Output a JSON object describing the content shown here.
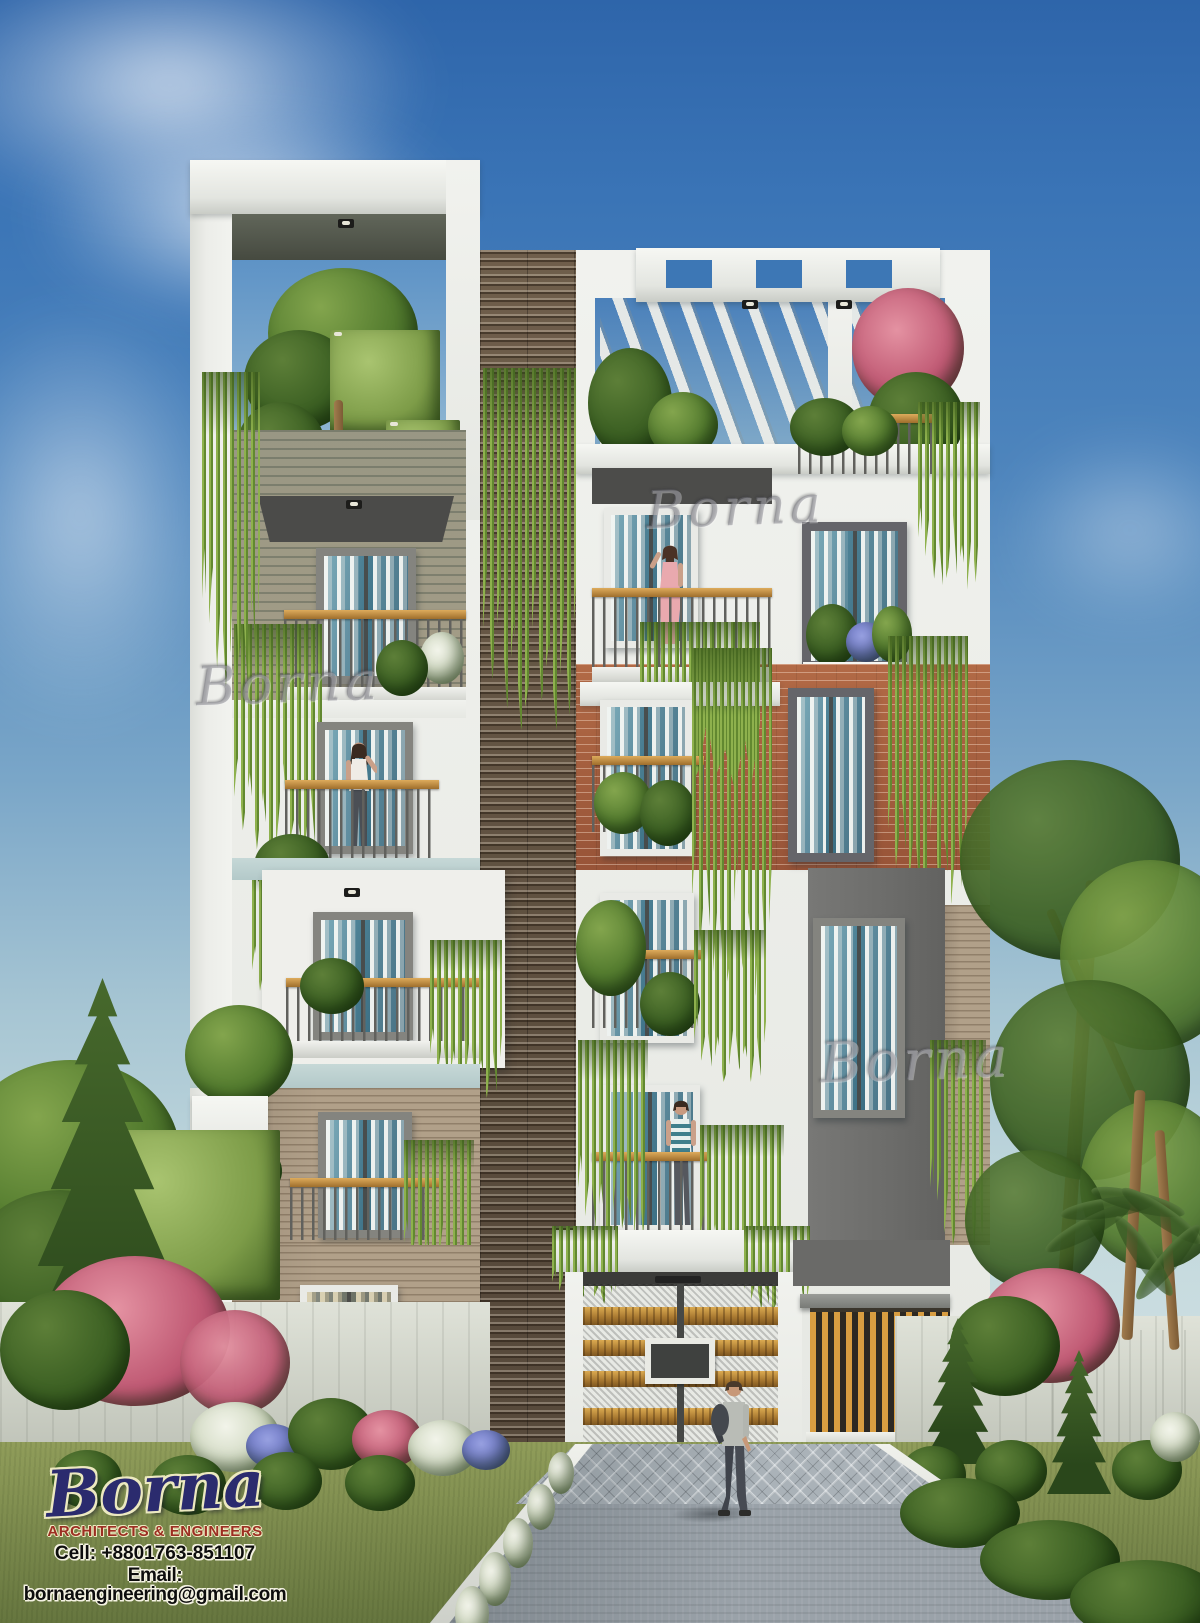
{
  "watermarks": [
    {
      "text": "Borna"
    },
    {
      "text": "Borna"
    },
    {
      "text": "Borna"
    }
  ],
  "logo": {
    "brand": "Borna",
    "tagline": "ARCHITECTS & ENGINEERS",
    "cell": "Cell: +8801763-851107",
    "email": "Email: bornaengineering@gmail.com"
  },
  "palette": {
    "sky_top": "#2e65aa",
    "sky_horizon": "#d4e2e2",
    "wall_white": "#eceeea",
    "brick_red": "#a8603f",
    "brick_tan": "#b1a089",
    "panel_gray": "#6d6d6b",
    "wood_accent": "#c8923f",
    "louver_brown": "#6f5e4b",
    "glass_teal": "#4e8296",
    "vine_green": "#7ca43e",
    "lawn_green": "#76854a",
    "brand_navy": "#2b2b6e",
    "brand_red": "#9c2e22",
    "brand_outline_cream": "#ece9c0"
  }
}
